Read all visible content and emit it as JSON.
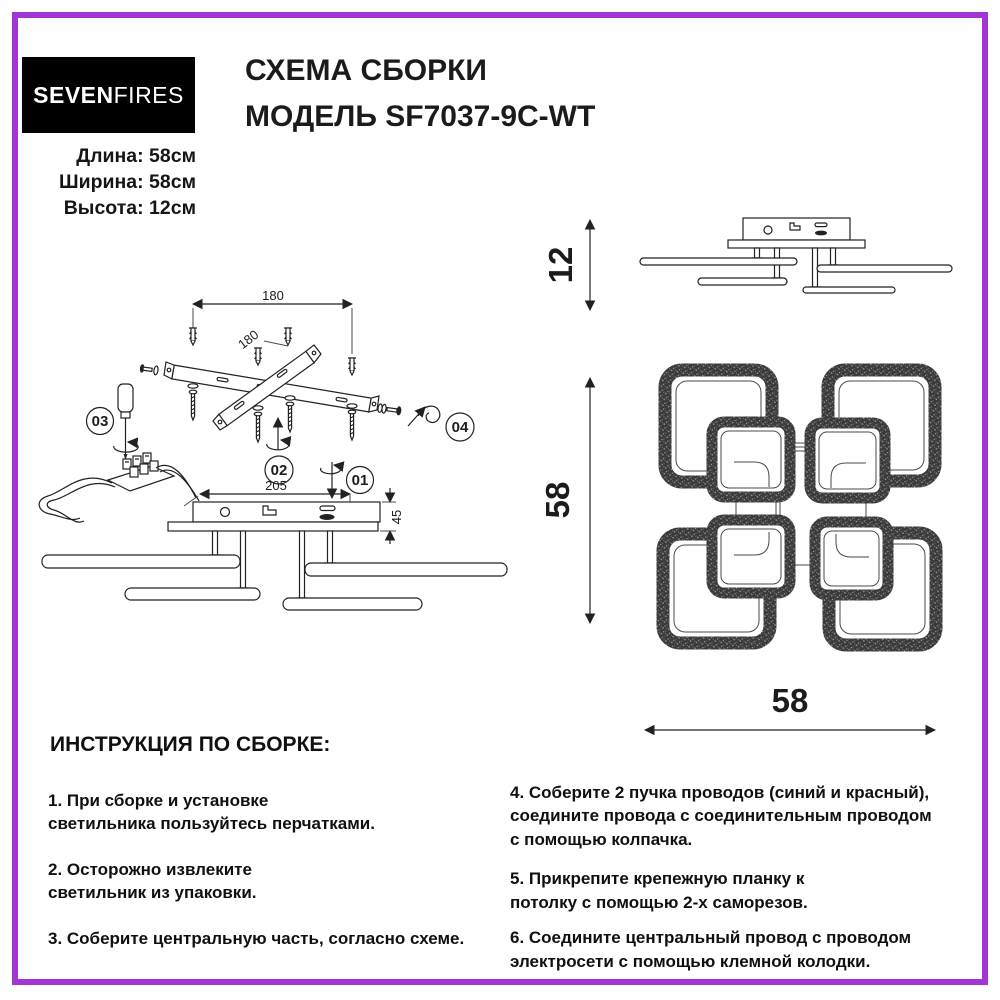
{
  "brand": {
    "logo_left": "SEVEN",
    "logo_right": "FIRES"
  },
  "header": {
    "title_line1": "СХЕМА СБОРКИ",
    "title_line2": "МОДЕЛЬ SF7037-9C-WT",
    "specs": [
      "Длина: 58см",
      "Ширина: 58см",
      "Высота: 12см"
    ]
  },
  "diagram": {
    "callouts": [
      "01",
      "02",
      "03",
      "04"
    ],
    "dims": {
      "bracket_span": "180",
      "bracket_diag": "180",
      "base_width": "205",
      "base_depth": "45",
      "height_side": "12",
      "plan_height": "58",
      "plan_width": "58"
    }
  },
  "instructions": {
    "heading": "ИНСТРУКЦИЯ ПО СБОРКЕ:",
    "left": [
      "1. При сборке и установке\nсветильника пользуйтесь перчатками.",
      "2. Осторожно извлеките\nсветильник из упаковки.",
      "3. Соберите центральную часть, согласно схеме."
    ],
    "right": [
      "4. Соберите 2 пучка проводов (синий и красный),\nсоедините провода с соединительным проводом\nс помощью колпачка.",
      "5. Прикрепите крепежную планку к\nпотолку с помощью 2-х саморезов.",
      "6. Соедините центральный провод с проводом\nэлектросети с помощью клемной колодки."
    ]
  },
  "colors": {
    "frame": "#A136D4",
    "ink": "#222222",
    "logo_bg": "#000000"
  }
}
